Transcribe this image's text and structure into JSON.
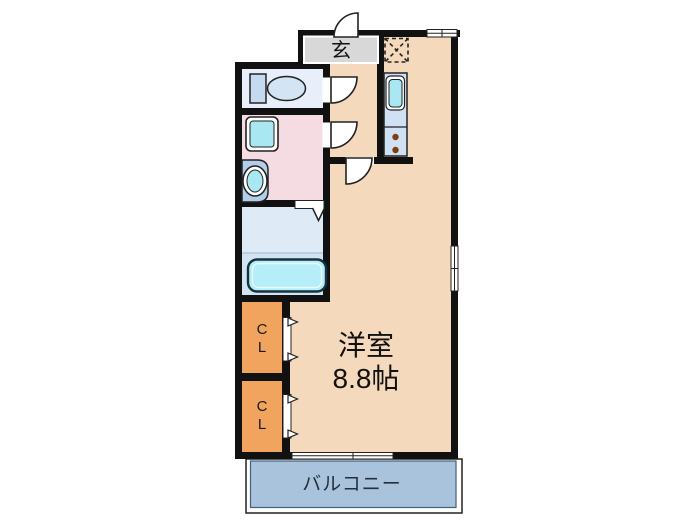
{
  "floorplan": {
    "entrance": {
      "label": "玄"
    },
    "main_room": {
      "name": "洋室",
      "size": "8.8帖"
    },
    "closet1": {
      "chars": [
        "C",
        "L"
      ]
    },
    "closet2": {
      "chars": [
        "C",
        "L"
      ]
    },
    "balcony": {
      "label": "バルコニー"
    }
  },
  "colors": {
    "wall": "#111111",
    "floor_main": "#f5d9bc",
    "toilet_floor": "#e8effa",
    "washroom_floor": "#f4dce2",
    "bathroom_floor_upper": "#dfeaf7",
    "bathroom_floor_lower": "#d2e4f4",
    "closet": "#f0a45e",
    "balcony_fill": "#a9c3dc",
    "genkan": "#d8d8d8",
    "counter": "#cfe1f3",
    "fixture_cyan": "#a9e7f2",
    "bathtub": "#b5eef8",
    "toilet_tank": "#c5daf0",
    "toilet_bowl": "#d3e4f5",
    "vanity": "#b3cdea",
    "burner": "#7b3f12",
    "balcony_text": "#232f3d"
  }
}
